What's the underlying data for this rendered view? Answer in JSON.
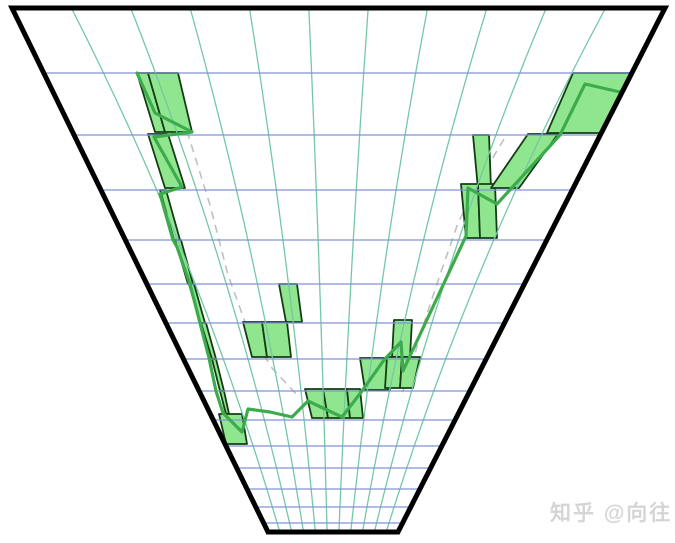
{
  "watermark": {
    "text": "知乎 @向往"
  },
  "chart_data": {
    "type": "line",
    "title": "",
    "description": "Perspective (funnel) projection of a chart: V-shaped sequence of green bars (candlestick-like bodies) with a green trend polyline and two gray dashed trend lines converging toward the valley bottom; green column lines converge to a vanishing point, blue horizontal gridlines compress with depth.",
    "frame": [
      [
        12,
        8
      ],
      [
        665,
        8
      ],
      [
        398,
        532
      ],
      [
        268,
        532
      ]
    ],
    "vanishing_point": [
      331.5,
      662
    ],
    "grid": {
      "blue_rows_y": [
        73,
        135,
        190,
        240,
        284,
        323,
        359,
        391,
        420,
        446,
        468,
        489,
        507,
        523
      ],
      "green_cols_x_top": [
        71.4,
        130.7,
        190.1,
        249.4,
        308.8,
        368.2,
        427.5,
        486.9,
        546.2,
        605.6
      ],
      "green_cols_x_bottom": [
        279.8,
        291.6,
        303.5,
        315.3,
        327.1,
        338.9,
        350.7,
        362.5,
        374.4,
        386.2
      ],
      "col_curve_bow": 0.12,
      "col_curve_control_y": 262
    },
    "bars": [
      [
        137,
        148,
        73,
        155,
        165,
        132
      ],
      [
        148,
        178,
        73,
        165,
        192,
        132
      ],
      [
        148,
        168,
        134,
        165,
        185,
        188
      ],
      [
        160,
        166,
        190,
        174,
        180,
        240
      ],
      [
        175,
        181,
        240,
        188,
        193,
        284
      ],
      [
        189,
        194,
        284,
        200,
        205,
        323
      ],
      [
        201,
        206,
        323,
        212,
        216,
        359
      ],
      [
        212,
        216,
        359,
        220,
        224,
        391
      ],
      [
        220,
        224,
        391,
        226,
        229,
        414
      ],
      [
        219,
        242,
        414,
        226,
        247,
        444
      ],
      [
        279,
        297,
        284,
        286,
        302,
        322
      ],
      [
        243,
        262,
        322,
        252,
        267,
        357
      ],
      [
        262,
        287,
        322,
        267,
        291,
        357
      ],
      [
        305,
        323,
        389,
        312,
        328,
        418
      ],
      [
        323,
        347,
        389,
        328,
        350,
        418
      ],
      [
        347,
        360,
        389,
        350,
        363,
        418
      ],
      [
        360,
        388,
        358,
        365,
        390,
        390
      ],
      [
        394,
        412,
        320,
        392,
        410,
        357
      ],
      [
        387,
        402,
        357,
        385,
        400,
        388
      ],
      [
        402,
        420,
        357,
        400,
        413,
        388
      ],
      [
        473,
        489,
        135,
        478,
        491,
        189
      ],
      [
        461,
        478,
        184,
        466,
        480,
        238
      ],
      [
        478,
        495,
        184,
        480,
        497,
        238
      ],
      [
        528,
        558,
        134,
        491,
        519,
        188
      ],
      [
        573,
        640,
        73,
        547,
        610,
        133
      ]
    ],
    "polyline": [
      [
        137,
        73
      ],
      [
        155,
        113
      ],
      [
        192,
        132
      ],
      [
        154,
        137
      ],
      [
        182,
        187
      ],
      [
        160,
        194
      ],
      [
        173,
        240
      ],
      [
        177,
        247
      ],
      [
        190,
        284
      ],
      [
        200,
        323
      ],
      [
        209,
        358
      ],
      [
        216,
        391
      ],
      [
        223,
        413
      ],
      [
        242,
        432
      ],
      [
        248,
        409
      ],
      [
        270,
        412
      ],
      [
        292,
        417
      ],
      [
        308,
        401
      ],
      [
        342,
        417
      ],
      [
        362,
        391
      ],
      [
        384,
        360
      ],
      [
        401,
        342
      ],
      [
        403,
        371
      ],
      [
        466,
        236
      ],
      [
        468,
        188
      ],
      [
        497,
        204
      ],
      [
        560,
        135
      ],
      [
        585,
        84
      ],
      [
        633,
        95
      ]
    ],
    "dashed_left": [
      [
        187,
        131
      ],
      [
        210,
        205
      ],
      [
        228,
        275
      ],
      [
        248,
        330
      ],
      [
        272,
        368
      ],
      [
        298,
        396
      ]
    ],
    "dashed_right": [
      [
        504,
        139
      ],
      [
        479,
        181
      ],
      [
        458,
        223
      ],
      [
        441,
        272
      ],
      [
        429,
        308
      ],
      [
        420,
        336
      ],
      [
        408,
        378
      ],
      [
        400,
        398
      ]
    ],
    "colors": {
      "background": "#ffffff",
      "frame": "#000000",
      "grid_green": "#74c8a3",
      "grid_blue": "#8094d8",
      "bar_fill": "#8fe68f",
      "bar_border": "#143d14",
      "trend_line": "#3cab4c",
      "dashed": "#c0c0c0",
      "watermark": "#d5d5d5"
    }
  }
}
